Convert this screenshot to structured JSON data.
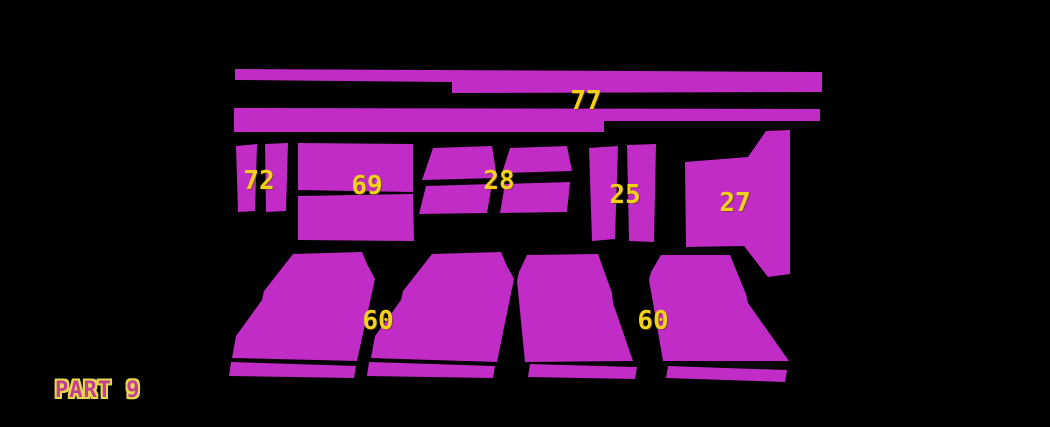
{
  "title": "PART 9",
  "colors": {
    "background": "#000000",
    "piece_fill": "#c12cc6",
    "number_color": "#f2d11c",
    "title_fill": "#c33e95",
    "title_outline": "#e8d84a"
  },
  "pieces": [
    {
      "id": "77",
      "number": "77",
      "label": {
        "x": 586,
        "y": 101
      },
      "polygons": [
        [
          [
            235,
            69
          ],
          [
            822,
            72
          ],
          [
            822,
            92
          ],
          [
            452,
            93
          ],
          [
            452,
            82
          ],
          [
            235,
            80
          ]
        ],
        [
          [
            234,
            108
          ],
          [
            820,
            109
          ],
          [
            820,
            121
          ],
          [
            604,
            121
          ],
          [
            604,
            132
          ],
          [
            234,
            132
          ]
        ]
      ]
    },
    {
      "id": "72",
      "number": "72",
      "label": {
        "x": 259,
        "y": 181
      },
      "polygons": [
        [
          [
            236,
            146
          ],
          [
            257,
            144
          ],
          [
            255,
            211
          ],
          [
            238,
            212
          ]
        ],
        [
          [
            265,
            144
          ],
          [
            288,
            143
          ],
          [
            286,
            211
          ],
          [
            266,
            212
          ]
        ]
      ]
    },
    {
      "id": "69",
      "number": "69",
      "label": {
        "x": 367,
        "y": 186
      },
      "polygons": [
        [
          [
            298,
            143
          ],
          [
            413,
            144
          ],
          [
            413,
            192
          ],
          [
            298,
            190
          ]
        ],
        [
          [
            298,
            196
          ],
          [
            413,
            194
          ],
          [
            414,
            241
          ],
          [
            298,
            240
          ]
        ]
      ]
    },
    {
      "id": "28",
      "number": "28",
      "label": {
        "x": 499,
        "y": 181
      },
      "polygons": [
        [
          [
            433,
            148
          ],
          [
            492,
            146
          ],
          [
            497,
            178
          ],
          [
            422,
            180
          ]
        ],
        [
          [
            510,
            148
          ],
          [
            567,
            146
          ],
          [
            572,
            171
          ],
          [
            502,
            173
          ]
        ],
        [
          [
            426,
            186
          ],
          [
            492,
            184
          ],
          [
            487,
            213
          ],
          [
            419,
            214
          ]
        ],
        [
          [
            505,
            184
          ],
          [
            570,
            182
          ],
          [
            567,
            212
          ],
          [
            500,
            213
          ]
        ]
      ]
    },
    {
      "id": "25",
      "number": "25",
      "label": {
        "x": 625,
        "y": 195
      },
      "polygons": [
        [
          [
            589,
            148
          ],
          [
            618,
            146
          ],
          [
            615,
            239
          ],
          [
            592,
            241
          ]
        ],
        [
          [
            627,
            145
          ],
          [
            656,
            144
          ],
          [
            654,
            242
          ],
          [
            629,
            241
          ]
        ]
      ]
    },
    {
      "id": "27",
      "number": "27",
      "label": {
        "x": 735,
        "y": 203
      },
      "polygons": [
        [
          [
            685,
            162
          ],
          [
            748,
            157
          ],
          [
            766,
            131
          ],
          [
            790,
            130
          ],
          [
            790,
            274
          ],
          [
            768,
            277
          ],
          [
            744,
            246
          ],
          [
            686,
            247
          ]
        ]
      ]
    },
    {
      "id": "60-left",
      "number": "60",
      "label": {
        "x": 378,
        "y": 321
      },
      "polygons": [
        [
          [
            293,
            254
          ],
          [
            362,
            252
          ],
          [
            367,
            264
          ],
          [
            375,
            279
          ],
          [
            357,
            361
          ],
          [
            232,
            358
          ],
          [
            236,
            336
          ],
          [
            262,
            300
          ],
          [
            264,
            291
          ]
        ],
        [
          [
            231,
            362
          ],
          [
            356,
            366
          ],
          [
            354,
            378
          ],
          [
            229,
            376
          ]
        ],
        [
          [
            432,
            254
          ],
          [
            501,
            252
          ],
          [
            506,
            264
          ],
          [
            514,
            279
          ],
          [
            497,
            362
          ],
          [
            371,
            358
          ],
          [
            375,
            336
          ],
          [
            401,
            300
          ],
          [
            403,
            291
          ]
        ],
        [
          [
            369,
            362
          ],
          [
            495,
            366
          ],
          [
            493,
            378
          ],
          [
            367,
            376
          ]
        ]
      ]
    },
    {
      "id": "60-right",
      "number": "60",
      "label": {
        "x": 653,
        "y": 321
      },
      "polygons": [
        [
          [
            527,
            255
          ],
          [
            598,
            254
          ],
          [
            612,
            293
          ],
          [
            613,
            303
          ],
          [
            633,
            361
          ],
          [
            525,
            362
          ],
          [
            517,
            281
          ],
          [
            519,
            272
          ]
        ],
        [
          [
            530,
            364
          ],
          [
            637,
            367
          ],
          [
            635,
            379
          ],
          [
            528,
            377
          ]
        ],
        [
          [
            661,
            255
          ],
          [
            730,
            255
          ],
          [
            746,
            294
          ],
          [
            748,
            303
          ],
          [
            789,
            361
          ],
          [
            663,
            361
          ],
          [
            649,
            280
          ],
          [
            651,
            272
          ]
        ],
        [
          [
            668,
            366
          ],
          [
            787,
            370
          ],
          [
            785,
            382
          ],
          [
            666,
            378
          ]
        ]
      ]
    }
  ]
}
